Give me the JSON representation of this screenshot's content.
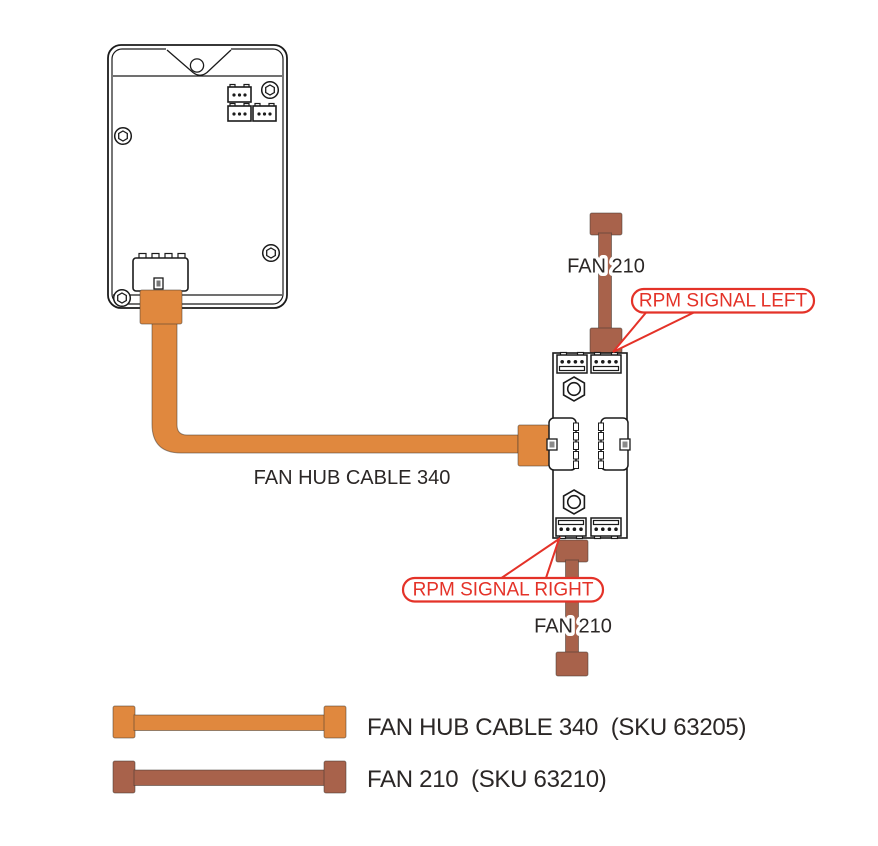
{
  "diagram": {
    "cable_label": "FAN HUB CABLE 340",
    "fan_top_label": "FAN 210",
    "fan_bottom_label": "FAN 210",
    "callout_left": "RPM SIGNAL LEFT",
    "callout_right": "RPM SIGNAL RIGHT"
  },
  "legend": {
    "items": [
      {
        "id": "fan-hub-cable-340",
        "label": "FAN HUB CABLE 340  (SKU 63205)",
        "color": "#E0883E"
      },
      {
        "id": "fan-210",
        "label": "FAN 210  (SKU 63210)",
        "color": "#A8624B"
      }
    ]
  },
  "colors": {
    "cable_orange": "#E0883E",
    "cable_brown": "#A8624B",
    "callout_red": "#E43228",
    "ink": "#2B2726",
    "line": "#1B1B1B"
  }
}
